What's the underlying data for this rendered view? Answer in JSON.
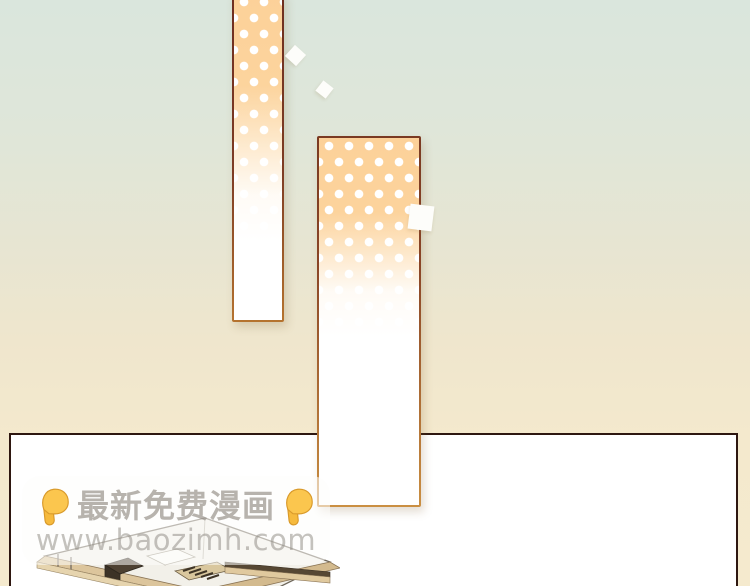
{
  "watermark": {
    "title_text": "最新免费漫画",
    "url_text": "www.baozimh.com",
    "finger_icon": "backhand-index-pointing-down",
    "text_color": "#8e8982",
    "hand_color": "#fbc64e",
    "box_color": "rgba(253,253,252,0.55)"
  },
  "artwork": {
    "background_gradient": [
      "#dae6dd",
      "#e7e5d2",
      "#f5eace"
    ],
    "dotted_panels": {
      "count": 2,
      "dot_color": "#ffffff",
      "fill_color": "#fcd7a2",
      "border_top_color": "#7a3a22",
      "border_bottom_color": "#ca8f42"
    },
    "frame_panel": {
      "fill": "#ffffff",
      "border_color": "#2e1710"
    },
    "confetti": {
      "count": 3,
      "color": "#fdfdfa"
    },
    "building_illustration": {
      "roof_color": "#f2f0e9",
      "wall_color": "#dcc59c",
      "shadow_color": "#4e4132"
    }
  }
}
